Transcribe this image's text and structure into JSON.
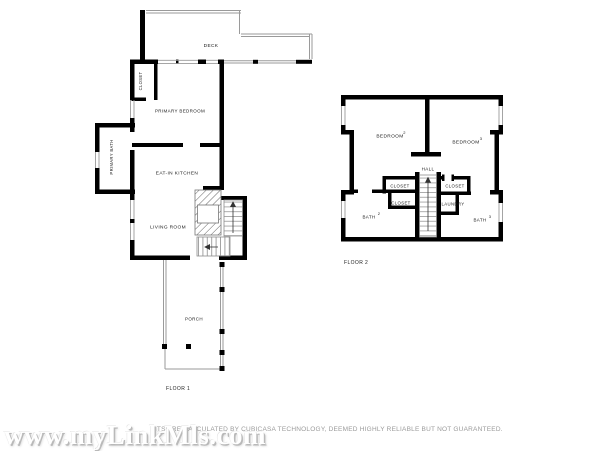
{
  "floor1": {
    "label": "FLOOR 1",
    "deck": "DECK",
    "closet": "CLOSET",
    "primary_bedroom": "PRIMARY BEDROOM",
    "primary_bath": "PRIMARY BATH",
    "eat_in_kitchen": "EAT-IN KITCHEN",
    "living_room": "LIVING ROOM",
    "porch": "PORCH"
  },
  "floor2": {
    "label": "FLOOR 2",
    "bedroom_left": "BEDROOM",
    "bedroom_left_num": "2",
    "bedroom_right": "BEDROOM",
    "bedroom_right_num": "3",
    "hall": "HALL",
    "closet_a": "CLOSET",
    "closet_b": "CLOSET",
    "closet_c": "CLOSET",
    "laundry": "LAUNDRY",
    "bath_left": "BATH",
    "bath_left_num": "2",
    "bath_right": "BATH",
    "bath_right_num": "3"
  },
  "footer": {
    "watermark": "www.myLinkMls.com",
    "disclaimer": "NTS ARE CALCULATED BY CUBICASA TECHNOLOGY, DEEMED HIGHLY RELIABLE BUT NOT GUARANTEED."
  },
  "colors": {
    "wall": "#000000",
    "thin_line": "#9a9a9a",
    "label_text": "#1a1a1a",
    "disclaimer_text": "#9a9a9a",
    "watermark_fill": "#ffffff",
    "watermark_shadow": "#b9b9b9"
  }
}
